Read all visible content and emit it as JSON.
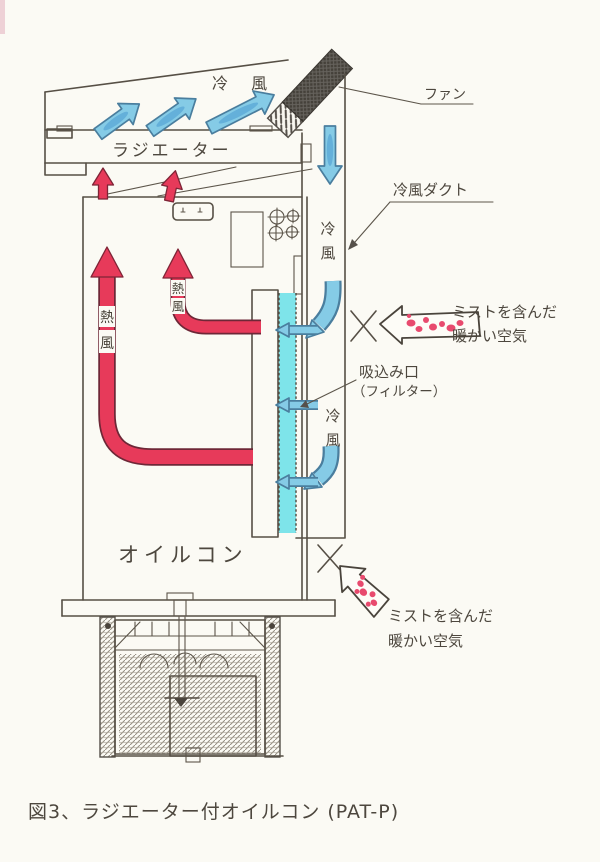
{
  "figure": {
    "caption": "図3、ラジエーター付オイルコン (PAT-P)"
  },
  "labels": {
    "fan": "ファン",
    "radiator": "ラジエーター",
    "cold_air_top": "冷 風",
    "cold_air": "冷風",
    "cold_air_duct": "冷風ダクト",
    "hot_air": "熱風",
    "intake_port": "吸込み口",
    "intake_filter": "（フィルター）",
    "mist_line1": "ミストを含んだ",
    "mist_line2": "暖かい空気",
    "oilcon": "オイルコン"
  },
  "colors": {
    "cold_arrow_fill": "#85cbe6",
    "cold_arrow_core": "#4f9fd2",
    "hot_arrow": "#e73a5a",
    "filter_strip": "#7ee4ea",
    "mist_dot": "#e84a6e",
    "ink": "#4d473e",
    "paper": "#fbfaf4"
  }
}
